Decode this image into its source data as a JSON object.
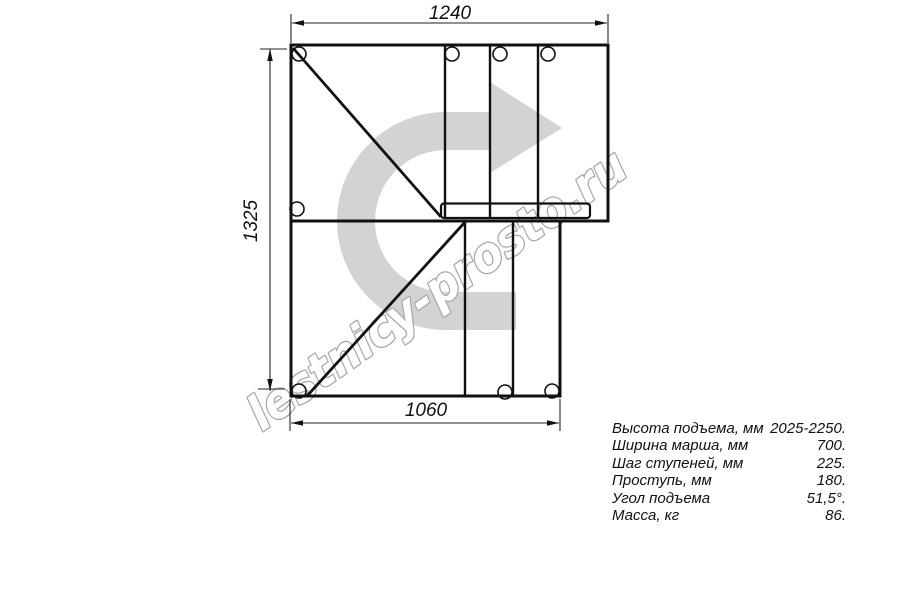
{
  "drawing": {
    "dim_top": "1240",
    "dim_left": "1325",
    "dim_bottom": "1060",
    "watermark": "lestnicy-prosto.ru",
    "arrow_color": "#d3d3d3",
    "watermark_outline": "#a8a8a8",
    "line_color": "#111111"
  },
  "specs": {
    "rows": [
      {
        "label": "Высота подъема, мм",
        "value": "2025-2250."
      },
      {
        "label": "Ширина марша, мм",
        "value": "700."
      },
      {
        "label": "Шаг ступеней, мм",
        "value": "225."
      },
      {
        "label": "Проступь, мм",
        "value": "180."
      },
      {
        "label": "Угол подъема",
        "value": "51,5°."
      },
      {
        "label": "Масса, кг",
        "value": "86."
      }
    ]
  }
}
